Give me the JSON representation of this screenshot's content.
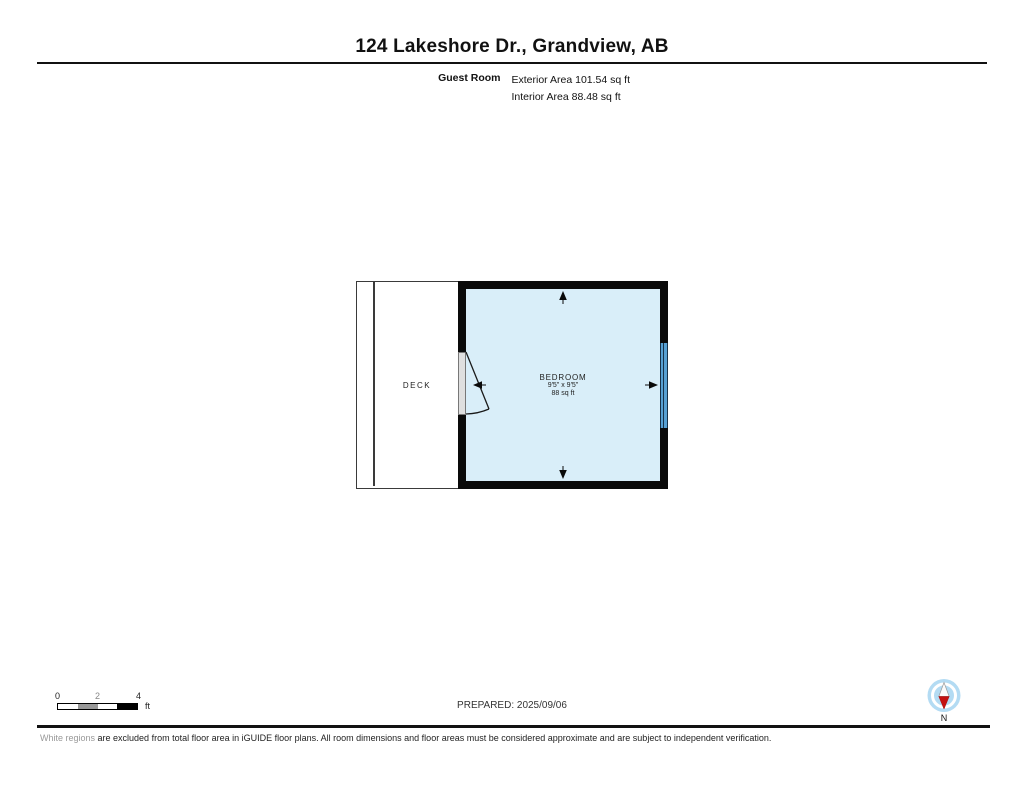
{
  "header": {
    "title": "124 Lakeshore Dr., Grandview, AB"
  },
  "floor_header": {
    "room_name": "Guest Room",
    "exterior_area": "Exterior Area 101.54 sq ft",
    "interior_area": "Interior Area 88.48 sq ft"
  },
  "floor_plan": {
    "deck_label": "DECK",
    "bedroom": {
      "label": "BEDROOM",
      "dimensions": "9'5\" x 9'5\"",
      "area": "88 sq ft"
    },
    "colors": {
      "room_fill": "#D9EEF9",
      "wall": "#0A0A0A",
      "window_blue": "#57A0D3",
      "door_gray": "#DFDFDF",
      "compass_blue": "#B3DBF3",
      "compass_needle_red": "#C41111"
    }
  },
  "scale_bar": {
    "tick_0": "0",
    "tick_2": "2",
    "tick_4": "4",
    "unit": "ft"
  },
  "footer": {
    "prepared": "PREPARED: 2025/09/06",
    "compass_label": "N",
    "disclaimer_lead": "White regions",
    "disclaimer_rest": " are excluded from total floor area in iGUIDE floor plans. All room dimensions and floor areas must be considered approximate and are subject to independent verification."
  }
}
